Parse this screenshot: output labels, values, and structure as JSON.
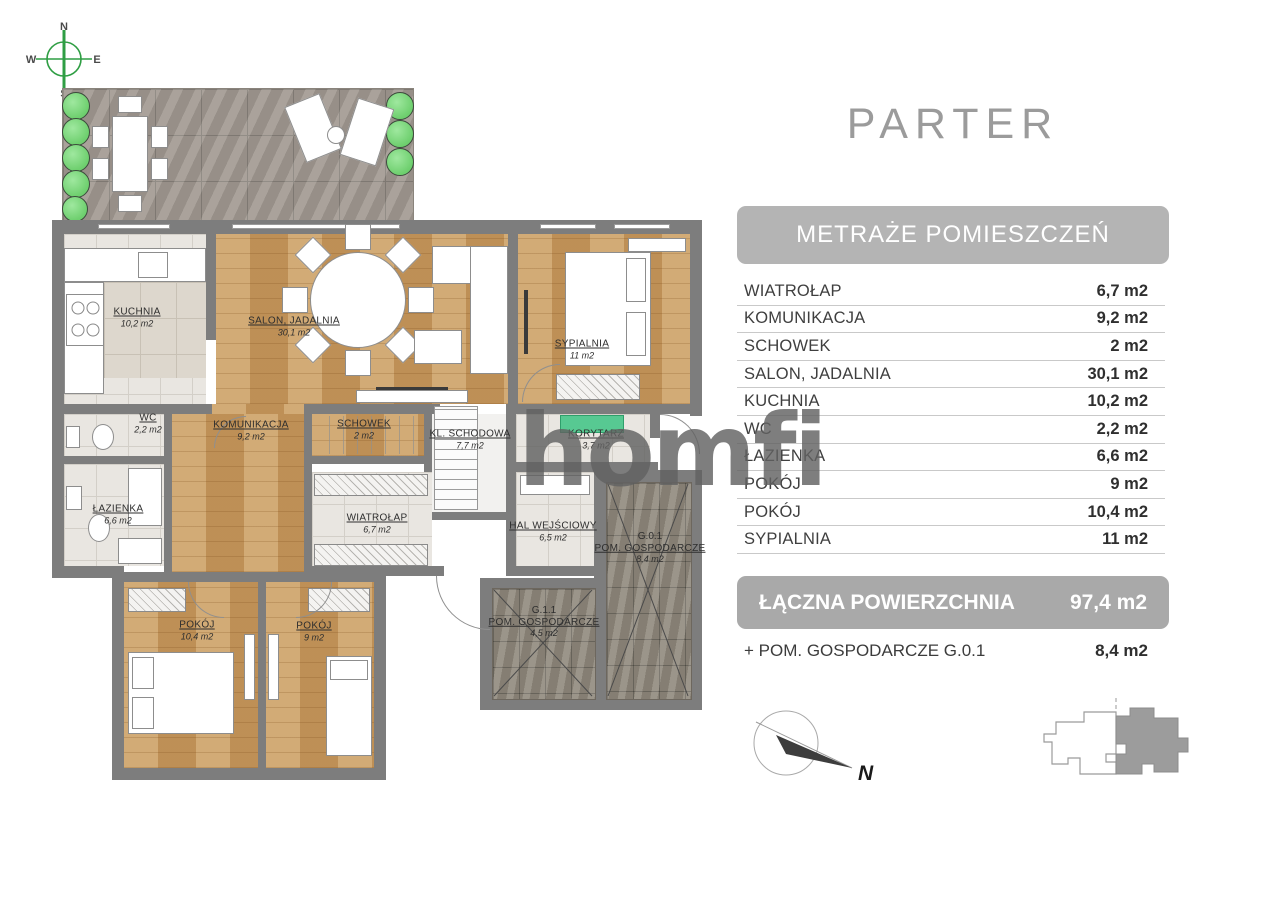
{
  "title": "PARTER",
  "watermark": "homfi",
  "legend": {
    "header": "METRAŻE POMIESZCZEŃ",
    "rows": [
      {
        "label": "WIATROŁAP",
        "value": "6,7 m2"
      },
      {
        "label": "KOMUNIKACJA",
        "value": "9,2 m2"
      },
      {
        "label": "SCHOWEK",
        "value": "2 m2"
      },
      {
        "label": "SALON, JADALNIA",
        "value": "30,1 m2"
      },
      {
        "label": "KUCHNIA",
        "value": "10,2 m2"
      },
      {
        "label": "WC",
        "value": "2,2 m2"
      },
      {
        "label": "ŁAZIENKA",
        "value": "6,6 m2"
      },
      {
        "label": "POKÓJ",
        "value": "9 m2"
      },
      {
        "label": "POKÓJ",
        "value": "10,4 m2"
      },
      {
        "label": "SYPIALNIA",
        "value": "11 m2"
      }
    ],
    "total_label": "ŁĄCZNA POWIERZCHNIA",
    "total_value": "97,4 m2",
    "extra_label": "+ POM. GOSPODARCZE G.0.1",
    "extra_value": "8,4 m2"
  },
  "plan": {
    "rooms": [
      {
        "id": "kuchnia",
        "name": "KUCHNIA",
        "area": "10,2 m2"
      },
      {
        "id": "salon",
        "name": "SALON, JADALNIA",
        "area": "30,1 m2"
      },
      {
        "id": "sypialnia",
        "name": "SYPIALNIA",
        "area": "11 m2"
      },
      {
        "id": "wc",
        "name": "WC",
        "area": "2,2 m2"
      },
      {
        "id": "komunikacja",
        "name": "KOMUNIKACJA",
        "area": "9,2 m2"
      },
      {
        "id": "schowek",
        "name": "SCHOWEK",
        "area": "2 m2"
      },
      {
        "id": "kl-schodowa",
        "name": "KL. SCHODOWA",
        "area": "7,7 m2"
      },
      {
        "id": "korytarz",
        "name": "KORYTARZ",
        "area": "3,7 m2"
      },
      {
        "id": "lazienka",
        "name": "ŁAZIENKA",
        "area": "6,6 m2"
      },
      {
        "id": "wiatrolap",
        "name": "WIATROŁAP",
        "area": "6,7 m2"
      },
      {
        "id": "hal",
        "name": "HAL WEJŚCIOWY",
        "area": "6,5 m2"
      },
      {
        "id": "g01",
        "code": "G.0.1",
        "name": "POM. GOSPODARCZE",
        "area": "8,4 m2"
      },
      {
        "id": "pokoj1",
        "name": "POKÓJ",
        "area": "10,4 m2"
      },
      {
        "id": "pokoj2",
        "name": "POKÓJ",
        "area": "9 m2"
      },
      {
        "id": "g11",
        "code": "G.1.1",
        "name": "POM. GOSPODARCZE",
        "area": "4,5 m2"
      }
    ],
    "compass_small": {
      "north": "N",
      "east": "E",
      "south": "S",
      "west": "W"
    },
    "compass_large": {
      "north": "N"
    }
  },
  "colors": {
    "wall": "#7d7d7d",
    "wood_floor": "#c79a60",
    "stone_terrace": "#a09890",
    "storage_floor": "#90897d",
    "header_bar": "#b4b4b4",
    "total_bar": "#a9a9a9",
    "title_gray": "#9b9b9b",
    "compass_green": "#2f9e44",
    "mat_green": "#57c992",
    "bush_green": "#6ecf6e"
  }
}
